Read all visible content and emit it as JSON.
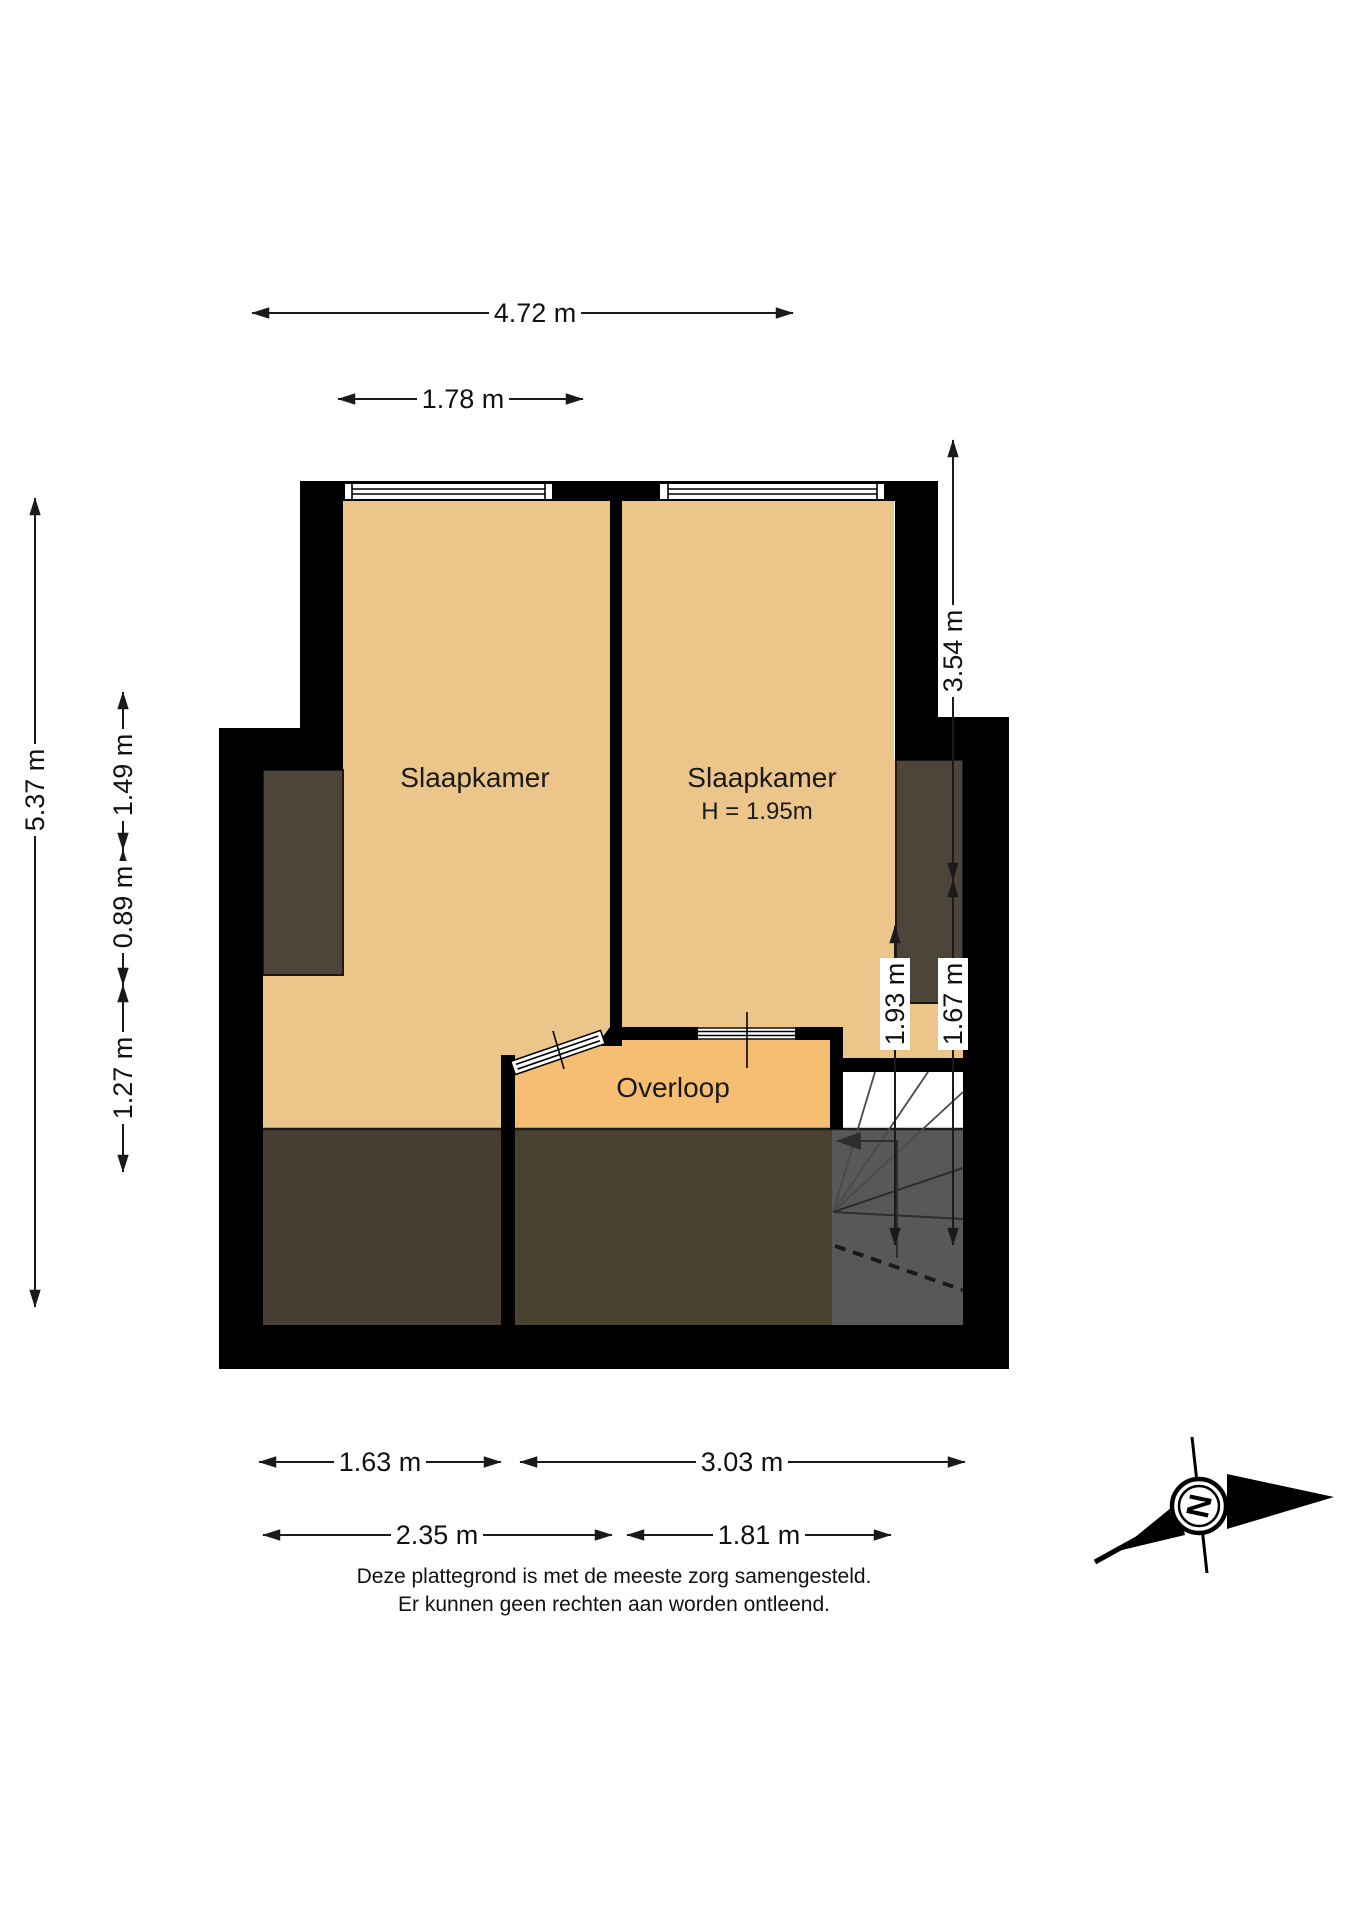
{
  "rooms": {
    "bedroom_left": {
      "label": "Slaapkamer"
    },
    "bedroom_right": {
      "label": "Slaapkamer",
      "height_note": "H = 1.95m"
    },
    "landing": {
      "label": "Overloop"
    }
  },
  "dimensions": {
    "top_overall": {
      "label": "4.72 m"
    },
    "top_left_room": {
      "label": "1.78 m"
    },
    "left_overall": {
      "label": "5.37 m"
    },
    "left_segment_1": {
      "label": "1.49 m"
    },
    "left_segment_2": {
      "label": "0.89 m"
    },
    "left_segment_3": {
      "label": "1.27 m"
    },
    "right_upper": {
      "label": "3.54 m"
    },
    "right_lower_inner": {
      "label": "1.93 m"
    },
    "right_lower_outer": {
      "label": "1.67 m"
    },
    "bottom_row1_left": {
      "label": "1.63 m"
    },
    "bottom_row1_right": {
      "label": "3.03 m"
    },
    "bottom_row2_left": {
      "label": "2.35 m"
    },
    "bottom_row2_right": {
      "label": "1.81 m"
    }
  },
  "compass": {
    "letter": "N"
  },
  "disclaimer": {
    "line1": "Deze plattegrond is met de meeste zorg samengesteld.",
    "line2": "Er kunnen geen rechten aan worden ontleend."
  },
  "colors": {
    "wall": "#000000",
    "room_fill": "#ECC58A",
    "landing_fill": "#F6BE72",
    "low_headroom_small": "#4D453A",
    "low_headroom_left": "#483F34",
    "low_headroom_mid": "#4A4230",
    "stair_shade": "#585858",
    "background": "#FFFFFF"
  }
}
